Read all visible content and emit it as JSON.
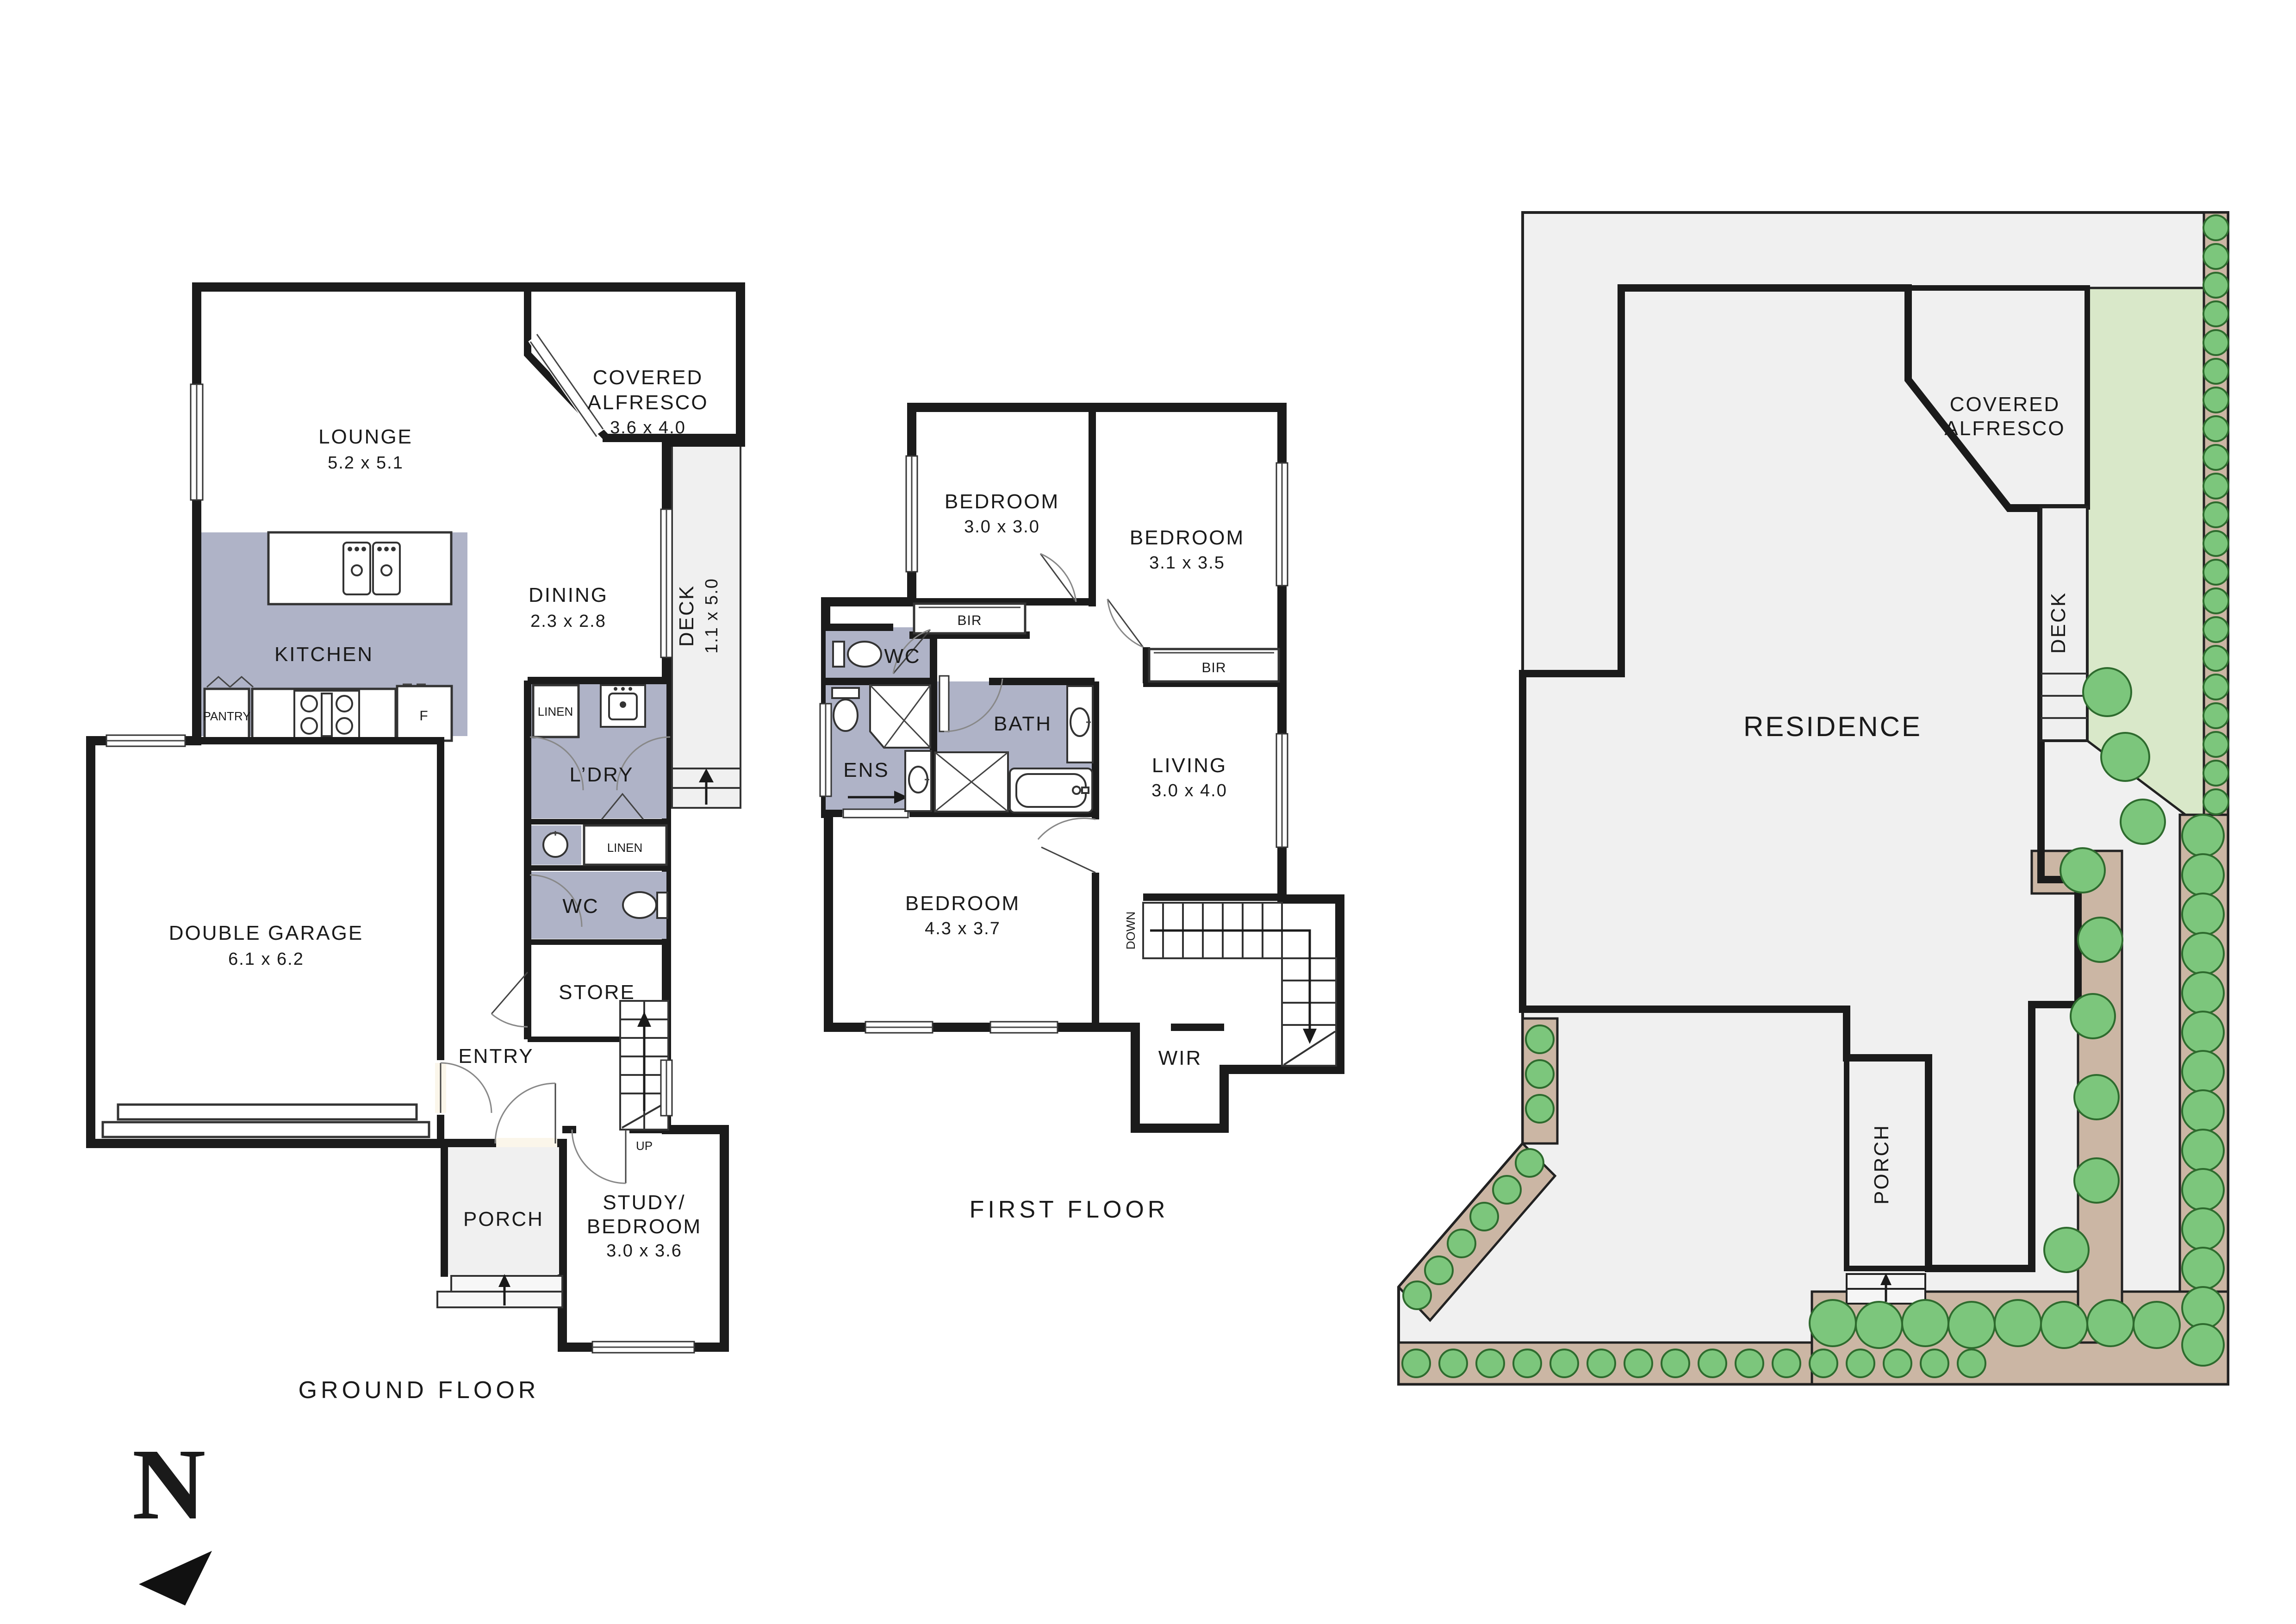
{
  "ground_floor": {
    "title": "GROUND FLOOR",
    "lounge": {
      "name": "LOUNGE",
      "dims": "5.2 x 5.1"
    },
    "alfresco": {
      "line1": "COVERED",
      "line2": "ALFRESCO",
      "dims": "3.6 x 4.0"
    },
    "dining": {
      "name": "DINING",
      "dims": "2.3 x 2.8"
    },
    "deck": {
      "name": "DECK",
      "dims": "1.1 x 5.0"
    },
    "kitchen": {
      "name": "KITCHEN"
    },
    "pantry": {
      "name": "PANTRY"
    },
    "fridge": {
      "name": "F"
    },
    "linen_a": {
      "name": "LINEN"
    },
    "laundry": {
      "name": "L’DRY"
    },
    "linen_b": {
      "name": "LINEN"
    },
    "wc": {
      "name": "WC"
    },
    "store": {
      "name": "STORE"
    },
    "stairs": {
      "name": "UP"
    },
    "garage": {
      "name": "DOUBLE GARAGE",
      "dims": "6.1 x 6.2"
    },
    "entry": {
      "name": "ENTRY"
    },
    "porch": {
      "name": "PORCH"
    },
    "study": {
      "line1": "STUDY/",
      "line2": "BEDROOM",
      "dims": "3.0 x 3.6"
    }
  },
  "first_floor": {
    "title": "FIRST FLOOR",
    "bedroom_small": {
      "name": "BEDROOM",
      "dims": "3.0 x 3.0"
    },
    "bedroom_mid": {
      "name": "BEDROOM",
      "dims": "3.1 x 3.5"
    },
    "bir_a": {
      "name": "BIR"
    },
    "bir_b": {
      "name": "BIR"
    },
    "wc": {
      "name": "WC"
    },
    "ens": {
      "name": "ENS"
    },
    "bath": {
      "name": "BATH"
    },
    "living": {
      "name": "LIVING",
      "dims": "3.0 x 4.0"
    },
    "bedroom_main": {
      "name": "BEDROOM",
      "dims": "4.3 x 3.7"
    },
    "stairs": {
      "name": "DOWN"
    },
    "wir": {
      "name": "WIR"
    }
  },
  "site_plan": {
    "residence": "RESIDENCE",
    "alfresco_line1": "COVERED",
    "alfresco_line2": "ALFRESCO",
    "deck": "DECK",
    "porch": "PORCH"
  },
  "compass": {
    "north": "N"
  },
  "colors": {
    "floor_cream": "#FBF6EA",
    "wet_area_grey": "#AFB3C7",
    "outdoor_grey": "#F0F0F0",
    "wall_black": "#1B1B1B",
    "lawn_green": "#D9E8C9",
    "shrub_green": "#7CC67C",
    "garden_tan": "#CBB6A4"
  }
}
